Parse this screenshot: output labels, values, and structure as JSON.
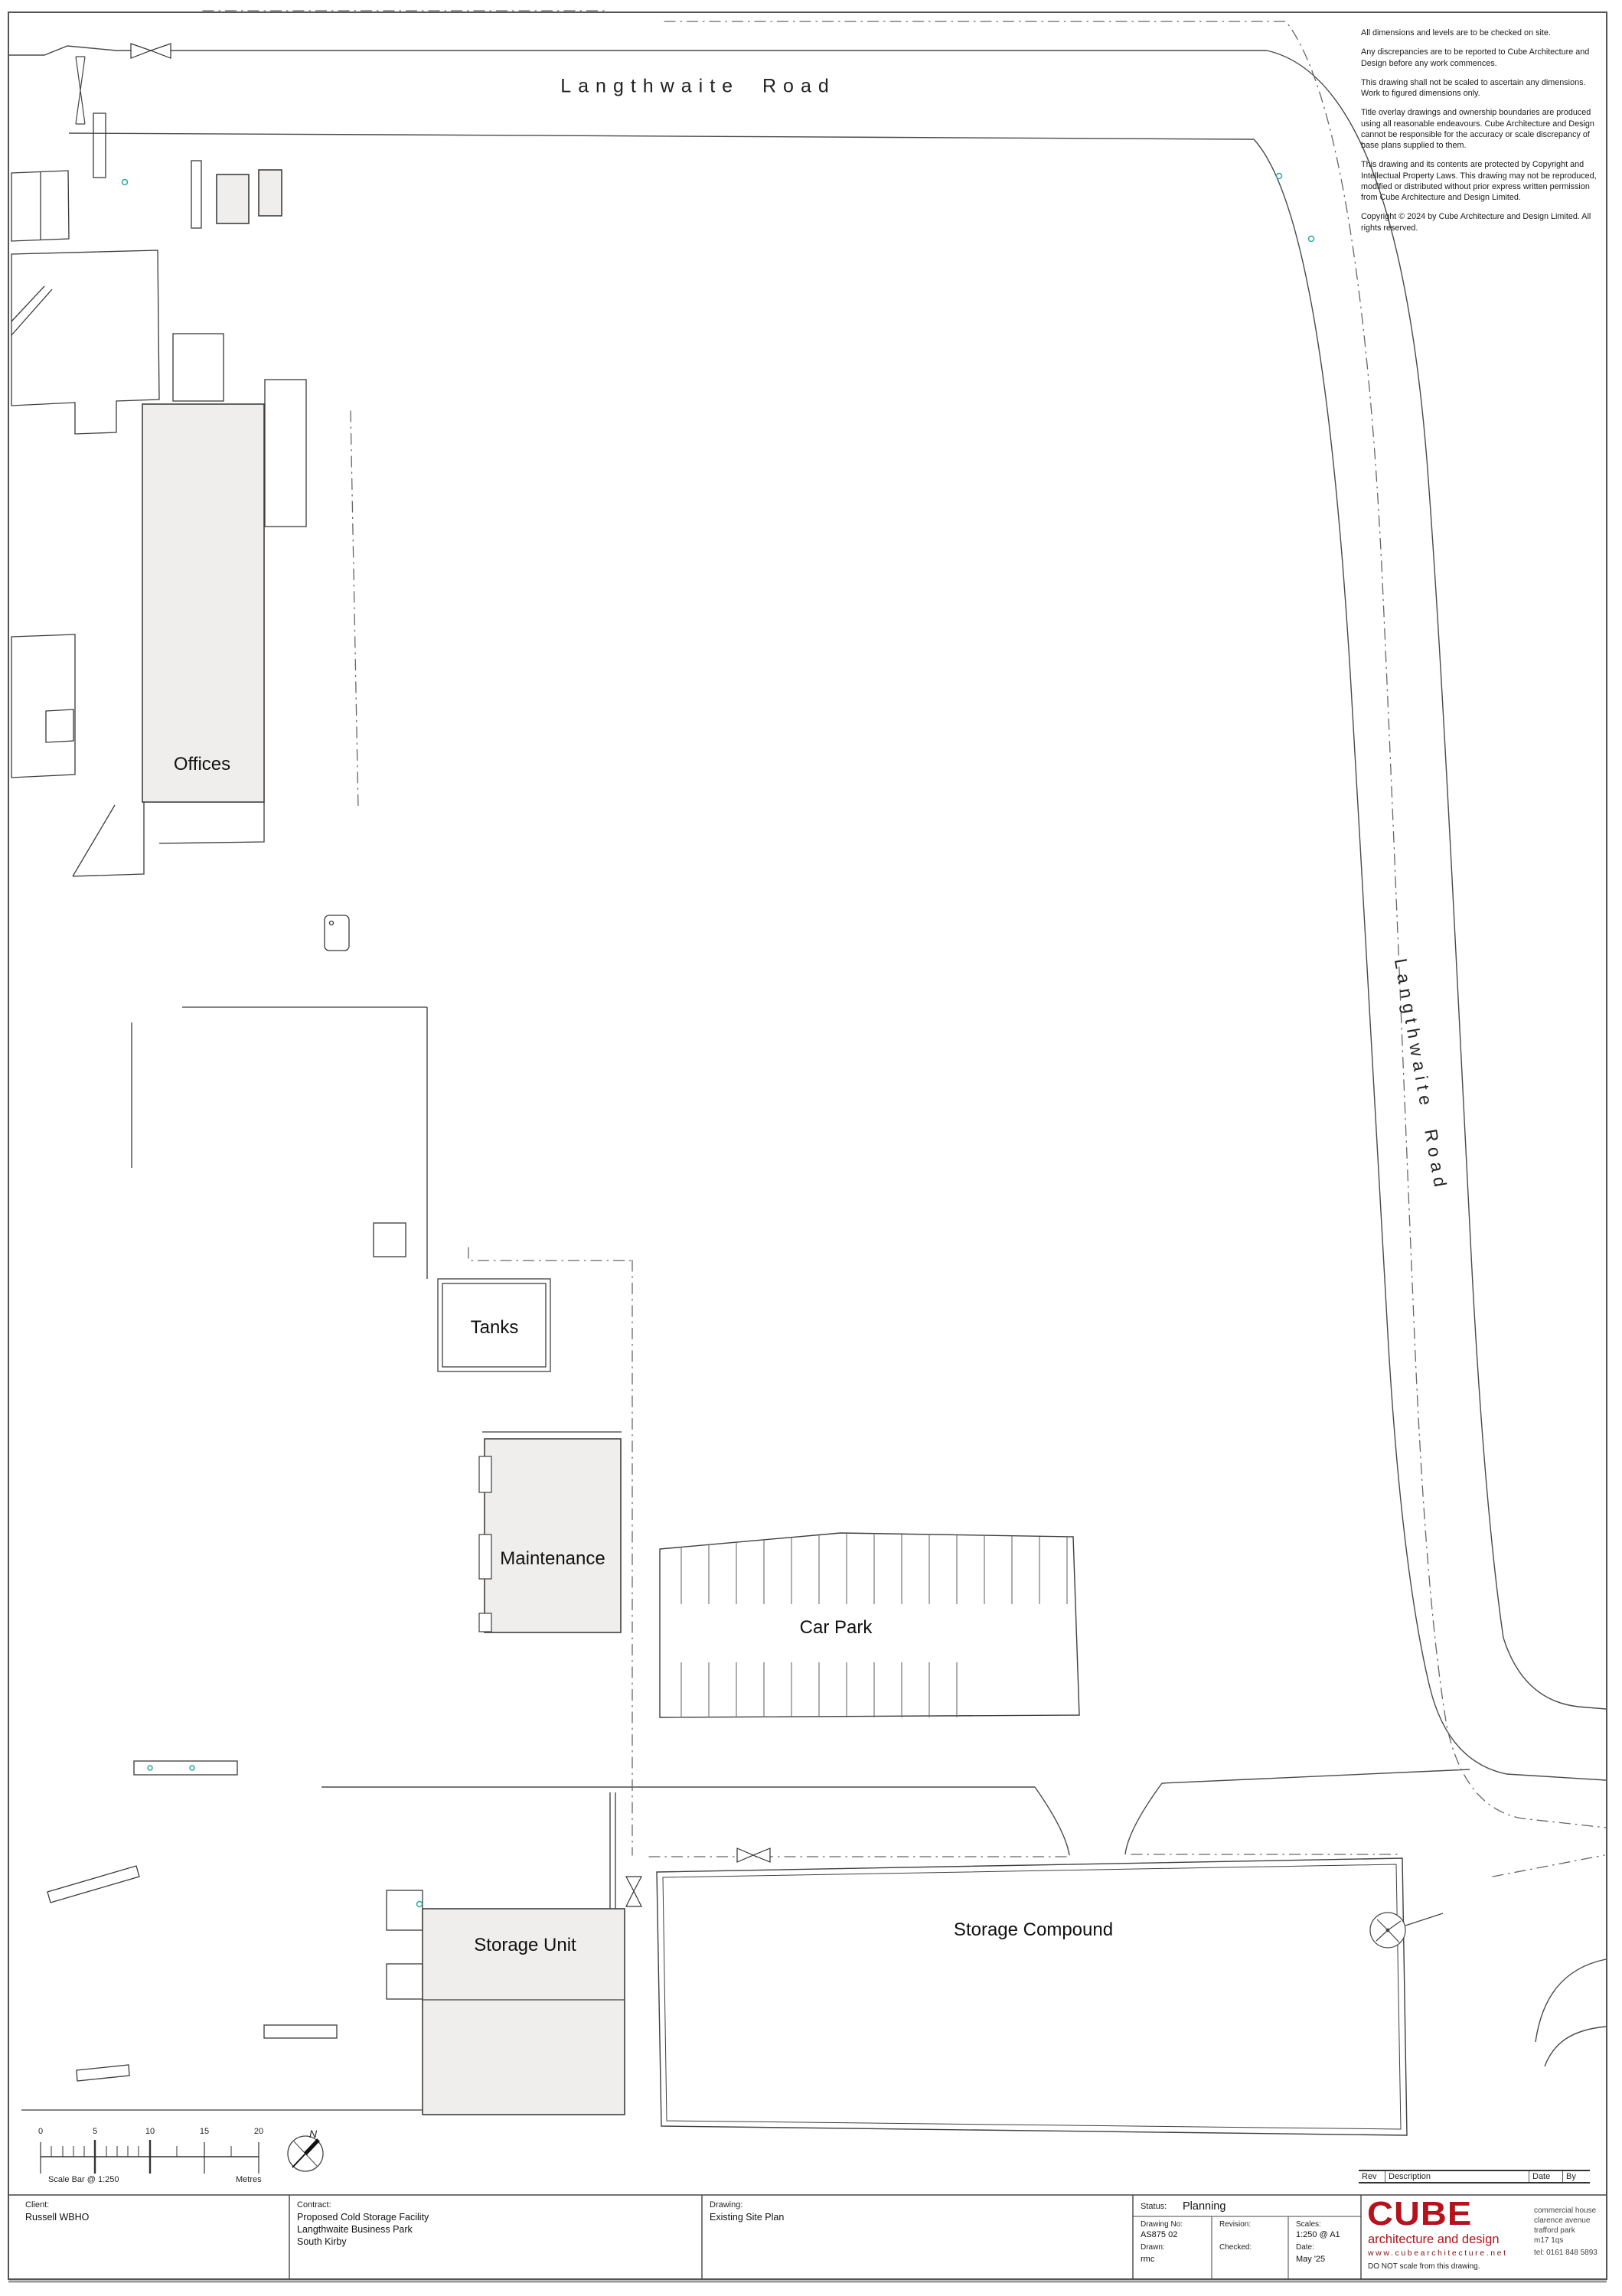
{
  "road_labels": {
    "top": "Langthwaite Road",
    "right": "Langthwaite Road"
  },
  "site_labels": {
    "offices": "Offices",
    "tanks": "Tanks",
    "maintenance": "Maintenance",
    "car_park": "Car Park",
    "storage_unit": "Storage Unit",
    "storage_compound": "Storage Compound"
  },
  "notes": [
    "All dimensions and levels are to be checked on site.",
    "Any discrepancies are to be reported to Cube Architecture and Design before any work commences.",
    "This drawing shall not be scaled to ascertain any dimensions. Work to figured dimensions only.",
    "Title overlay drawings and ownership boundaries are produced using all reasonable endeavours. Cube Architecture and Design cannot be responsible for the accuracy or scale discrepancy of base plans supplied to them.",
    "This drawing and its contents are protected by Copyright and Intellectual Property Laws. This drawing may not be reproduced, modified or distributed without prior express written permission from Cube Architecture and Design Limited.",
    "Copyright © 2024 by Cube Architecture and Design Limited. All rights reserved."
  ],
  "scale_bar": {
    "ticks": [
      "0",
      "5",
      "10",
      "15",
      "20"
    ],
    "caption": "Scale Bar @ 1:250",
    "unit": "Metres",
    "north_label": "N"
  },
  "revision_table": {
    "headers": [
      "Rev",
      "Description",
      "Date",
      "By"
    ]
  },
  "title_block": {
    "client_label": "Client:",
    "client": "Russell WBHO",
    "contract_label": "Contract:",
    "contract_line1": "Proposed Cold Storage Facility",
    "contract_line2": "Langthwaite Business Park",
    "contract_line3": "South Kirby",
    "drawing_label": "Drawing:",
    "drawing": "Existing Site Plan",
    "status_label": "Status:",
    "status": "Planning",
    "drawing_no_label": "Drawing No:",
    "drawing_no": "AS875 02",
    "drawn_label": "Drawn:",
    "drawn": "rmc",
    "revision_label": "Revision:",
    "revision": "",
    "checked_label": "Checked:",
    "checked": "",
    "scales_label": "Scales:",
    "scales": "1:250 @ A1",
    "date_label": "Date:",
    "date": "May '25"
  },
  "branding": {
    "logo_text": "CUBE",
    "tagline": "architecture and design",
    "website": "www.cubearchitecture.net",
    "address_line1": "commercial house",
    "address_line2": "clarence avenue",
    "address_line3": "trafford park",
    "address_line4": "m17 1qs",
    "phone": "tel: 0161 848 5893",
    "do_not_scale": "DO NOT scale from this drawing.",
    "brand_red": "#b5121b"
  },
  "colors": {
    "building_fill": "#efeeec",
    "line": "#3a3a3a",
    "boundary": "#666666",
    "survey_marker_teal": "#2aa7a0"
  }
}
